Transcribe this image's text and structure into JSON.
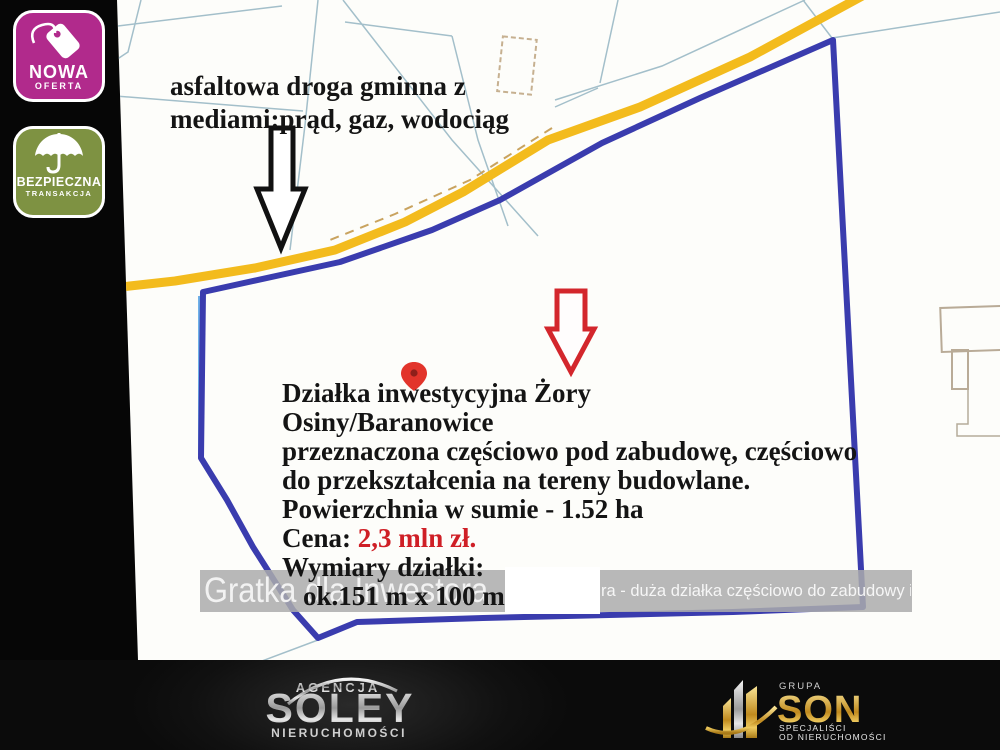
{
  "badges": {
    "new_offer": {
      "title": "NOWA",
      "subtitle": "OFERTA",
      "color": "#b12a8c"
    },
    "safe_trade": {
      "title": "BEZPIECZNA",
      "subtitle": "TRANSAKCJA",
      "color": "#7e9242"
    }
  },
  "annotations": {
    "road_note_line1": "asfaltowa droga gminna z",
    "road_note_line2": "mediami:prąd, gaz, wodociąg",
    "listing": {
      "line1": "Działka inwestycyjna Żory",
      "line2": "Osiny/Baranowice",
      "line3": "przeznaczona częściowo pod zabudowę, częściowo",
      "line4": "do przekształcenia na tereny budowlane.",
      "line5": "Powierzchnia w sumie - 1.52 ha",
      "price_label": "Cena: ",
      "price_value": "2,3 mln zł.",
      "line7": "Wymiary działki:",
      "line8": "ok.151 m x 100 m"
    }
  },
  "watermark": {
    "brand": "Gratka dla Inwestora",
    "listing_fragment": "ra - duża działka częściowo do zabudowy i do przekształ"
  },
  "footer": {
    "soley": {
      "top": "AGENCJA",
      "name": "SOLEY",
      "bottom": "NIERUCHOMOŚCI"
    },
    "son": {
      "top": "GRUPA",
      "name": "SON",
      "sub1": "SPECJALIŚCI",
      "sub2": "OD NIERUCHOMOŚCI"
    }
  },
  "colors": {
    "plot_outline_blue": "#3a3cae",
    "road_yellow": "#f3bb1d",
    "price_red": "#cf1f26",
    "badge_magenta": "#b12a8c",
    "badge_green": "#7e9242",
    "parcel_line_teal": "#a3bfca"
  }
}
